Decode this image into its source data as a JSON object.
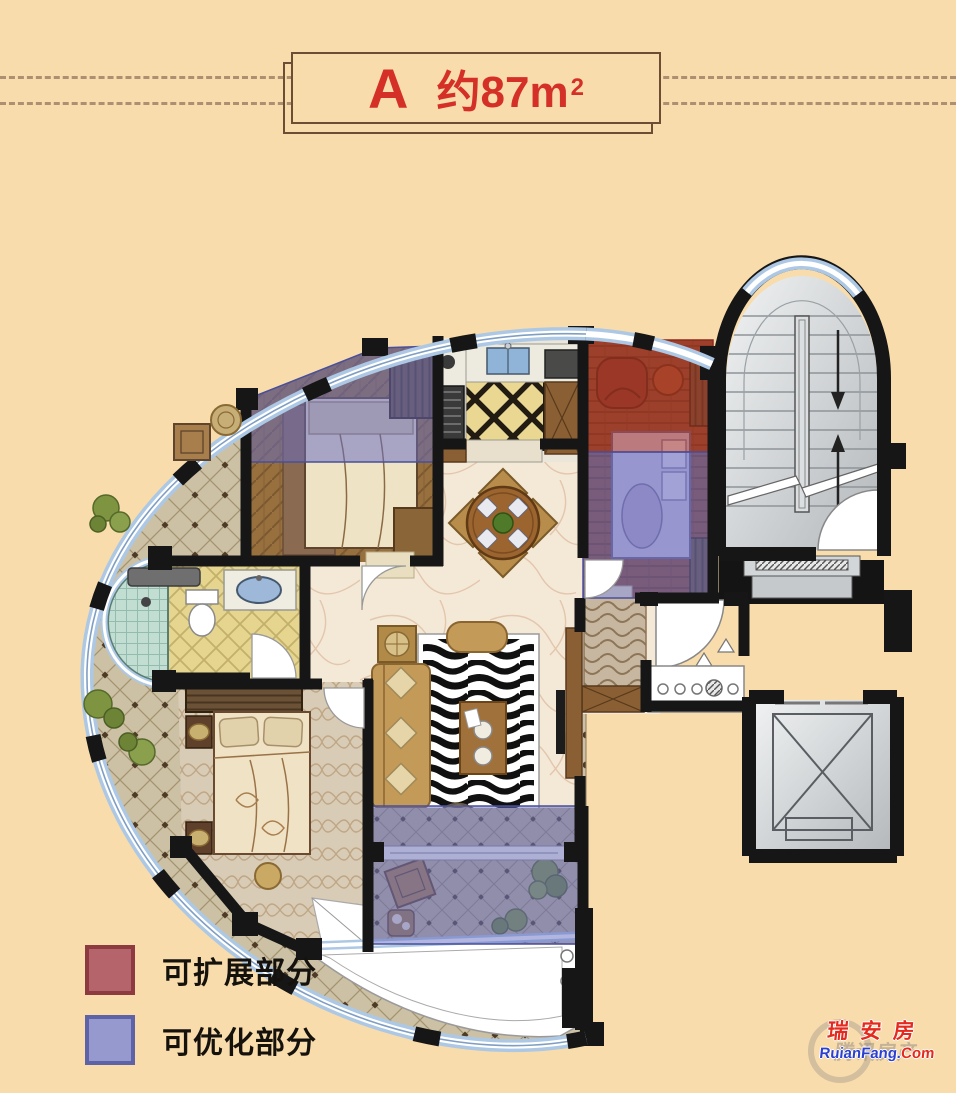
{
  "page": {
    "background_color": "#f9dcab"
  },
  "header": {
    "unit_letter": "A",
    "area_text": "约87m",
    "area_exponent": "2",
    "title_color": "#d43028"
  },
  "legend": {
    "items": [
      {
        "id": "expandable",
        "label": "可扩展部分",
        "fill": "#b4646a",
        "border": "#8e3a41"
      },
      {
        "id": "optimizable",
        "label": "可优化部分",
        "fill": "#9599cd",
        "border": "#5d63a6"
      }
    ]
  },
  "watermark": {
    "brand_cn": "瑞安房",
    "brand_url_prefix": "RuianFang.",
    "brand_url_suffix": "Com",
    "backdrop_brand": "腾讯房产"
  },
  "overlay_colors": {
    "expandable_red": "#a83524",
    "optimizable_purple": "#666cc0"
  }
}
